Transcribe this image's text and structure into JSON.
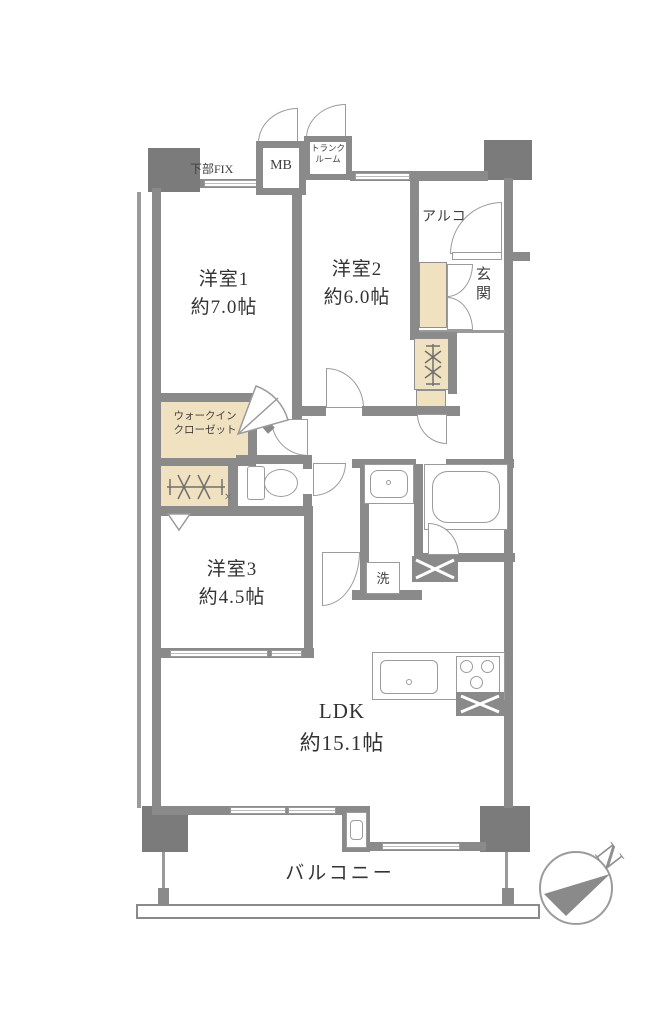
{
  "colors": {
    "wall": "#8a8a8a",
    "pillar": "#7b7b7b",
    "closet_beige": "#f0e2c1",
    "fixture_line": "#9b9b9b",
    "text": "#3e3e3e"
  },
  "labels": {
    "kabu_fix": "下部FIX",
    "mb": "MB",
    "trunk_line1": "トランク",
    "trunk_line2": "ルーム",
    "alcove": "アルコープ",
    "genkan": "玄関",
    "room1_name": "洋室1",
    "room1_size": "約7.0帖",
    "room2_name": "洋室2",
    "room2_size": "約6.0帖",
    "room3_name": "洋室3",
    "room3_size": "約4.5帖",
    "wic_line1": "ウォークイン",
    "wic_line2": "クローゼット",
    "laundry": "洗",
    "ldk_name": "LDK",
    "ldk_size": "約15.1帖",
    "balcony": "バルコニー",
    "compass_north": "N",
    "corner_mark": "✕"
  }
}
